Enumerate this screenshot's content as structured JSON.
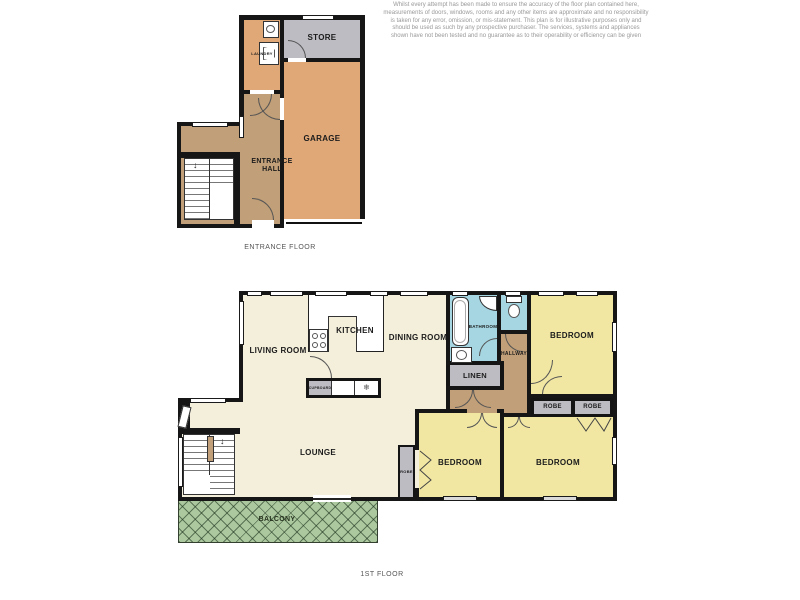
{
  "disclaimer": "Whilst every attempt has been made to ensure the accuracy of the floor plan contained here, measurements of doors, windows, rooms and any other items are approximate and no responsibility is taken for any error, omission, or mis-statement. This plan is for illustrative purposes only and should be used as such by any prospective purchaser. The services, systems and appliances shown have not been tested and no guarantee as to their operability or efficiency can be given",
  "entrance_floor": {
    "label": "ENTRANCE FLOOR",
    "rooms": {
      "laundry": "LAUNDRY",
      "store": "STORE",
      "garage": "GARAGE",
      "entrance_hall": "ENTRANCE HALL"
    }
  },
  "first_floor": {
    "label": "1ST FLOOR",
    "rooms": {
      "living_room": "LIVING ROOM",
      "kitchen": "KITCHEN",
      "dining_room": "DINING ROOM",
      "bathroom": "BATHROOM",
      "hallway": "HALLWAY",
      "linen": "LINEN",
      "bedroom_top": "BEDROOM",
      "bedroom_middle": "BEDROOM",
      "bedroom_right": "BEDROOM",
      "robe_left": "ROBE",
      "robe_right": "ROBE",
      "robe_small": "ROBE",
      "lounge": "LOUNGE",
      "balcony": "BALCONY",
      "cupboard": "CUPBOARD"
    }
  },
  "icons": {
    "freezer": "❄",
    "stair_arrow": "↓"
  },
  "colors": {
    "wall": "#161616",
    "open_plan_cream": "#f4efdb",
    "bedroom_yellow": "#f1e7a3",
    "bathroom_blue": "#a5d6e2",
    "hallway_tan": "#c19f78",
    "garage_orange": "#e0a877",
    "store_gray": "#bcbcc2",
    "balcony_green": "#abc89e"
  }
}
